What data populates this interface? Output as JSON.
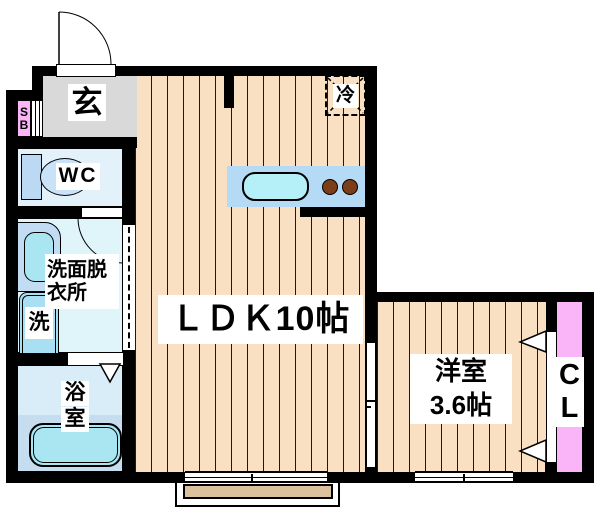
{
  "plan": {
    "type": "floorplan",
    "rooms": {
      "genkan": {
        "label": "玄"
      },
      "shoe_box": {
        "line1": "S",
        "line2": "B"
      },
      "wc": {
        "label": "WC"
      },
      "washroom": {
        "line1": "洗面脱",
        "line2": "衣所"
      },
      "washing_machine": {
        "label": "洗"
      },
      "bathroom": {
        "line1": "浴",
        "line2": "室"
      },
      "ldk": {
        "label": "ＬＤＫ10帖"
      },
      "refrigerator": {
        "label": "冷"
      },
      "western_room": {
        "line1": "洋室",
        "line2": "3.6帖"
      },
      "closet": {
        "line1": "C",
        "line2": "L"
      }
    },
    "colors": {
      "wall": "#000000",
      "flooring": "#FAE0C2",
      "genkan_floor": "#D9D9D9",
      "water_room_fill": "#E0F5F9",
      "fixture_blue": "#B4DAF6",
      "fixture_cyan": "#ACE9F2",
      "closet_pink": "#F9B5F7",
      "burner_brown": "#7B3E19",
      "balcony_tan": "#DCC29C"
    }
  }
}
